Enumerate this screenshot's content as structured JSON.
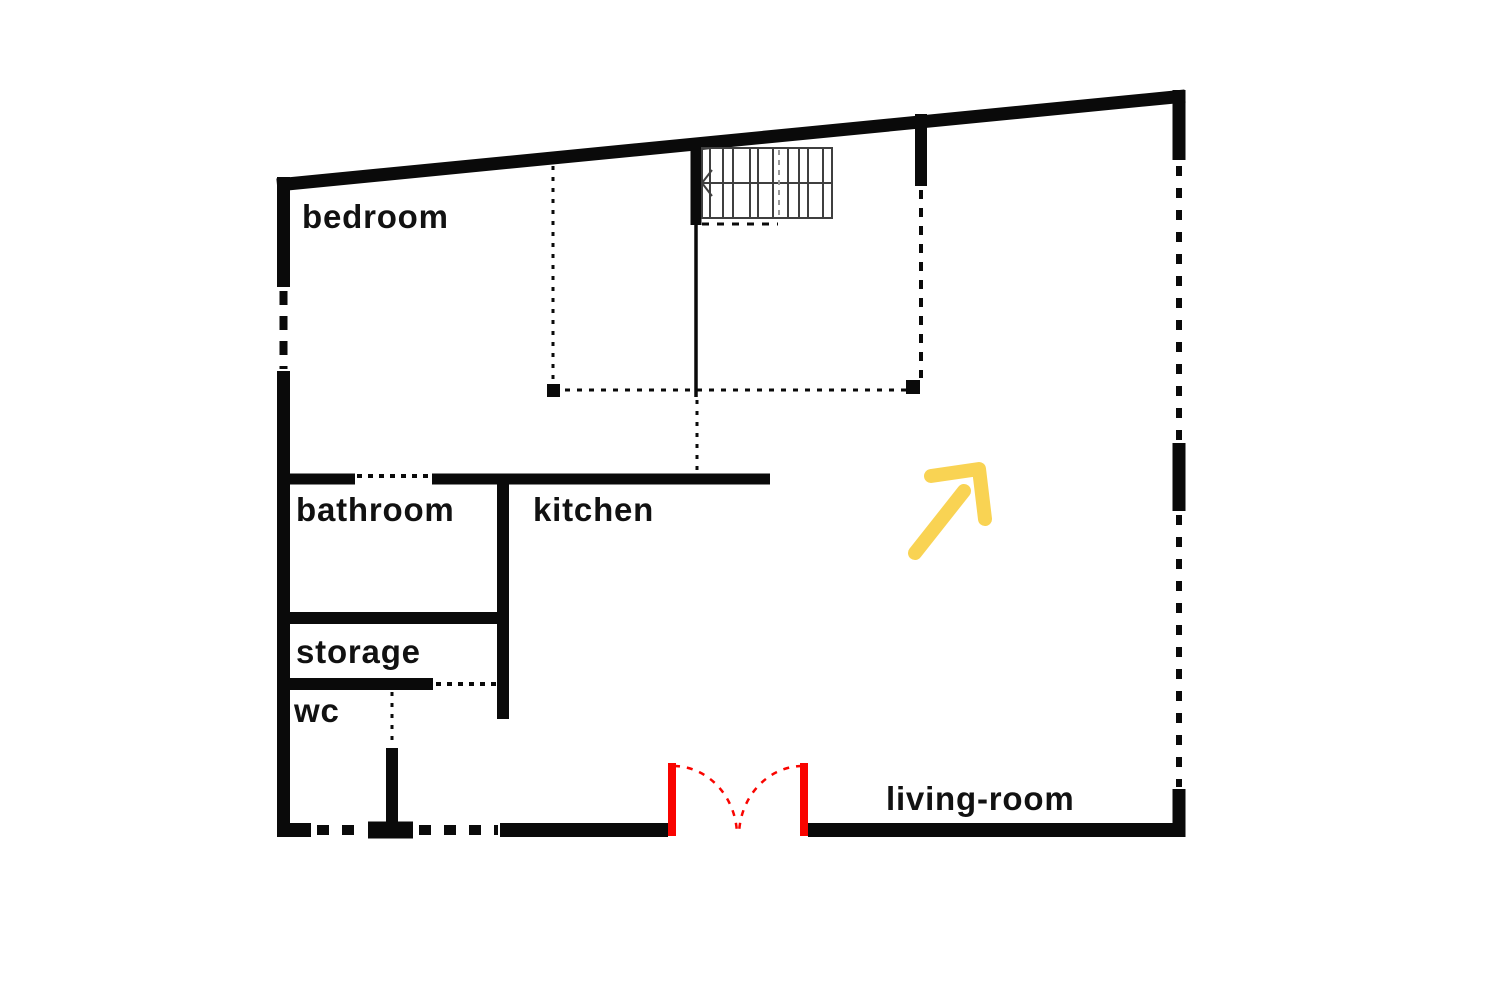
{
  "document": {
    "type": "floor-plan",
    "background": "#ffffff"
  },
  "colors": {
    "wall": "#0a0a0a",
    "stair_outline": "#3f3f3f",
    "stair_guide": "#999999",
    "door": "#f90400",
    "arrow": "#f9d353",
    "label": "#111111"
  },
  "rooms": [
    {
      "id": "bedroom",
      "label": "bedroom"
    },
    {
      "id": "bathroom",
      "label": "bathroom"
    },
    {
      "id": "kitchen",
      "label": "kitchen"
    },
    {
      "id": "storage",
      "label": "storage"
    },
    {
      "id": "wc",
      "label": "wc"
    },
    {
      "id": "living-room",
      "label": "living-room"
    }
  ],
  "symbols": {
    "staircase": "staircase-with-direction-arrow",
    "entrance": "double-swing-door",
    "direction_arrow": "up-right"
  }
}
